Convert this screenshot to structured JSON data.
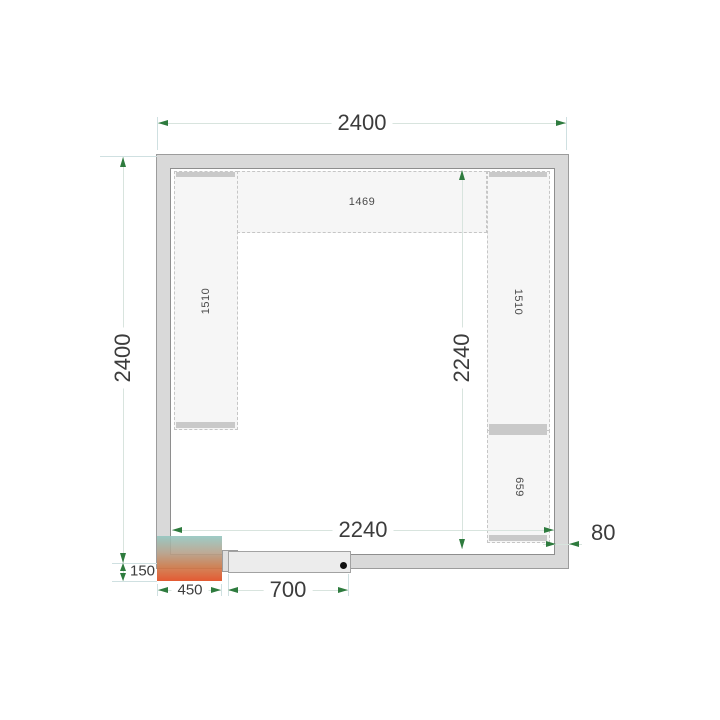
{
  "diagram": {
    "dims": {
      "outer_width": "2400",
      "outer_height": "2400",
      "inner_width": "2240",
      "inner_height": "2240",
      "wall_thickness": "80",
      "door_width": "700",
      "unit_width": "450",
      "unit_height": "150"
    },
    "shelves": {
      "top": "1469",
      "left": "1510",
      "right_upper": "1510",
      "right_lower": "659"
    },
    "colors": {
      "wall_fill": "#d9d9d9",
      "wall_border": "#9c9c9c",
      "shelf_fill": "#f6f6f6",
      "dimension_line": "#d8e4de",
      "extension_line": "#cfe0e1",
      "arrow": "#2e7b3e",
      "text": "#3c3c3c",
      "unit_gradient_top": "#93c6c0",
      "unit_gradient_bottom": "#e0481c",
      "door_fill": "#ececec",
      "door_handle": "#111111"
    }
  }
}
